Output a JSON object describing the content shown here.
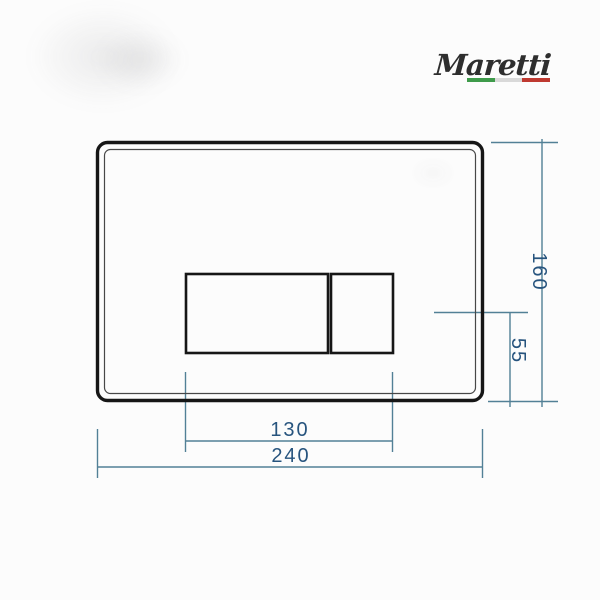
{
  "page": {
    "background": "#fcfcfc",
    "description": "Technical dimension drawing of a wall-mounted flush plate, front view"
  },
  "brand": {
    "name": "Maretti",
    "flag_colors": {
      "green": "#3f9b4b",
      "white": "#d9d9d9",
      "red": "#bf3a31"
    }
  },
  "drawing": {
    "colors": {
      "outline": "#161616",
      "dimension_line": "#528096",
      "dimension_text": "#27547e"
    },
    "dimensions": {
      "overall_width": "240",
      "overall_height": "160",
      "buttons_width": "130",
      "buttons_offset_from_bottom": "55"
    }
  }
}
